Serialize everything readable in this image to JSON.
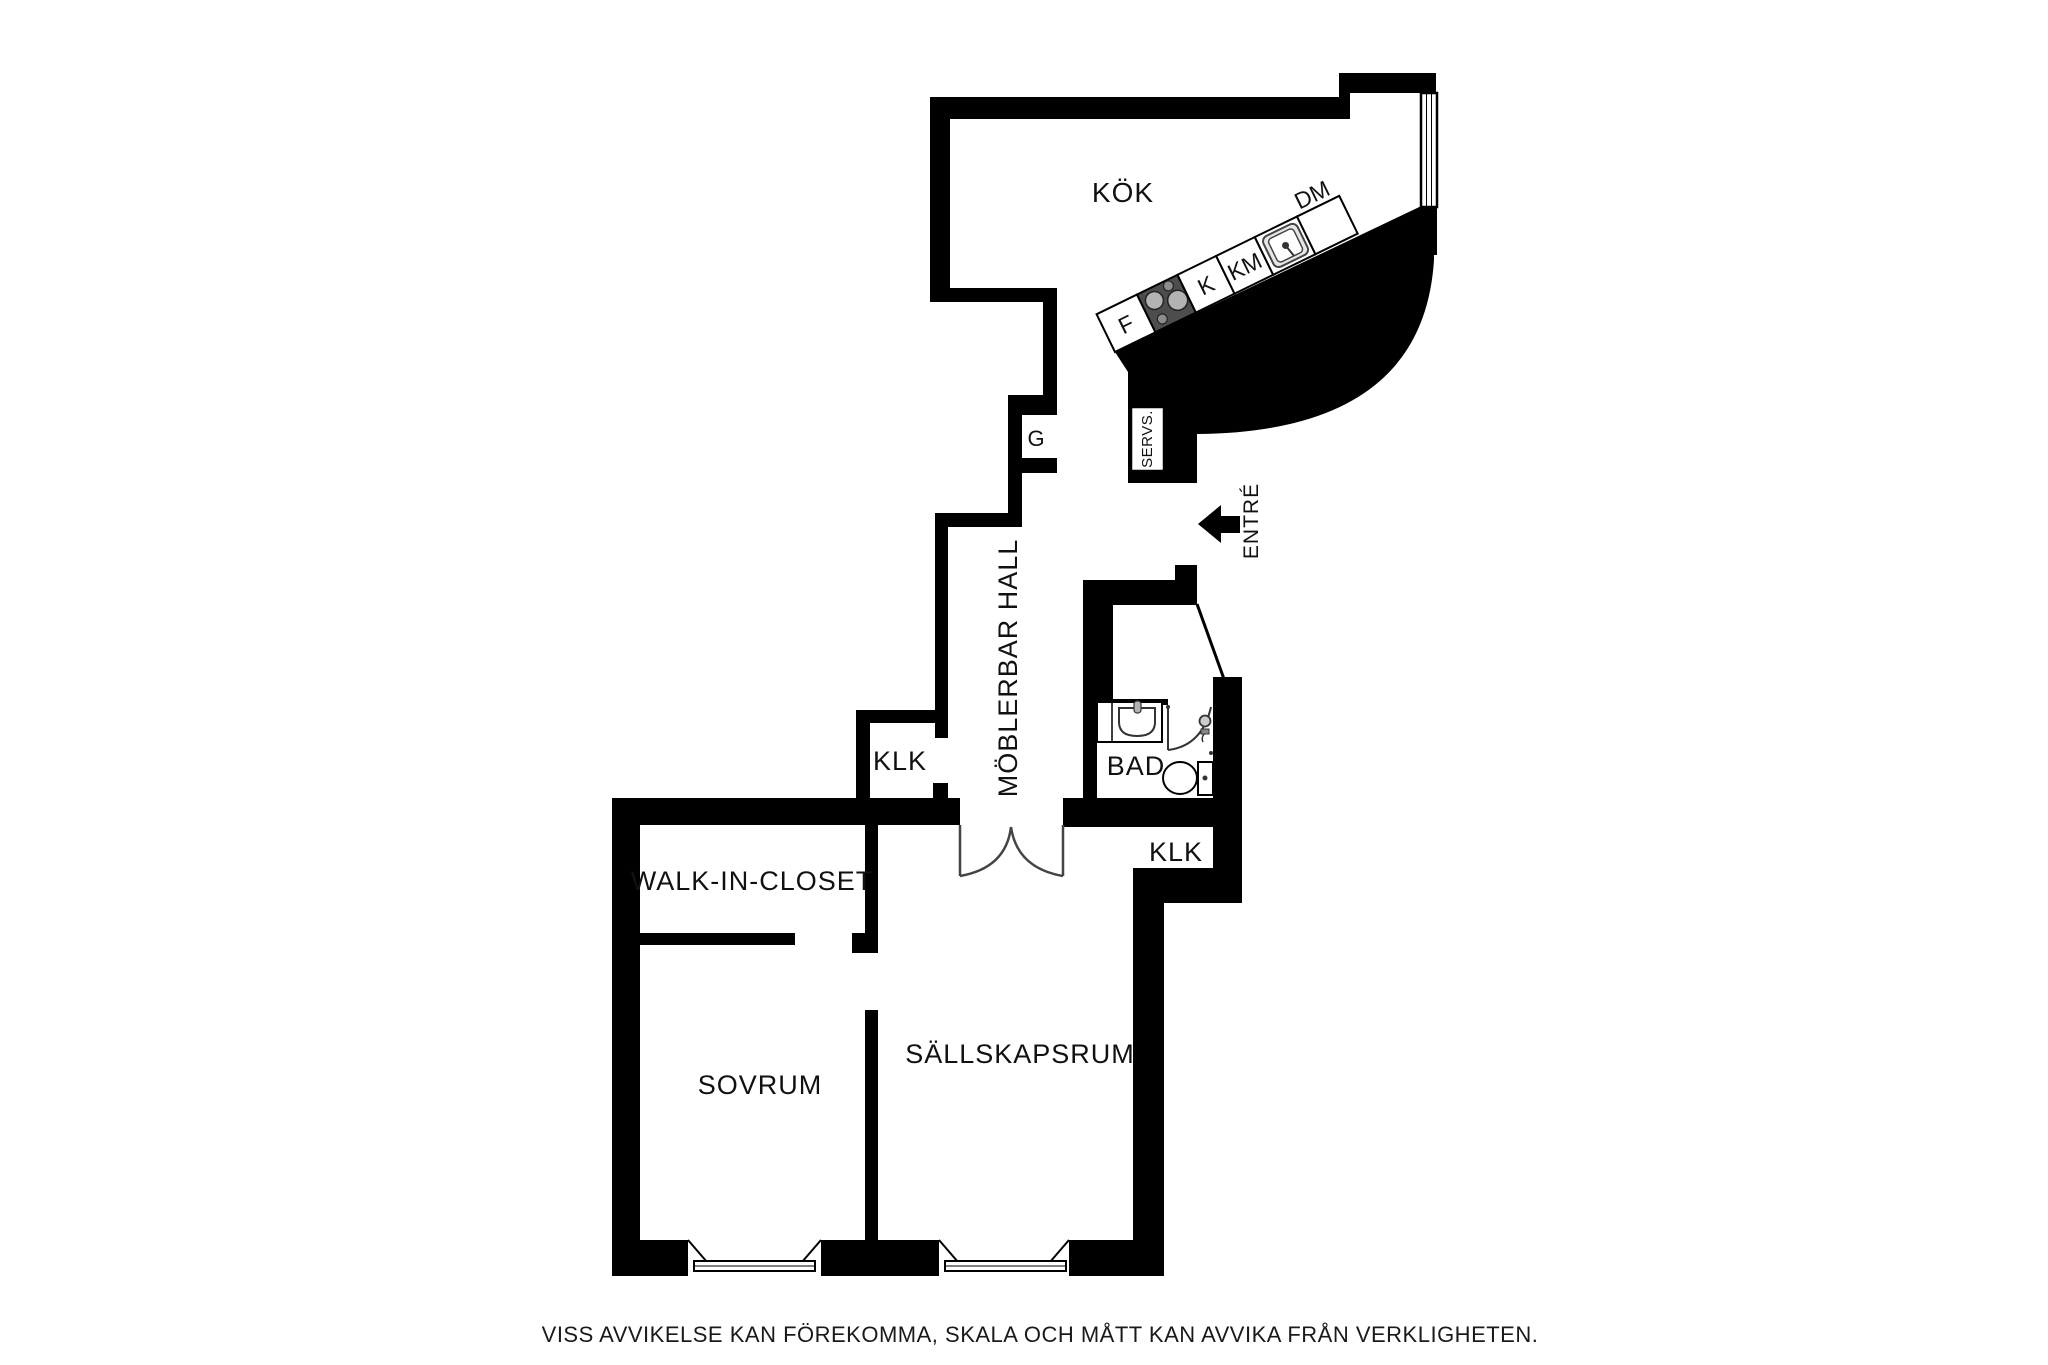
{
  "page": {
    "disclaimer": "VISS AVVIKELSE KAN FÖREKOMMA, SKALA OCH MÅTT KAN AVVIKA FRÅN VERKLIGHETEN."
  },
  "floorplan": {
    "rooms": {
      "kok": "KÖK",
      "hall": "MÖBLERBAR HALL",
      "klk_upper": "KLK",
      "bad": "BAD",
      "klk_lower": "KLK",
      "walk_in_closet": "WALK-IN-CLOSET",
      "sovrum": "SOVRUM",
      "sallskapsrum": "SÄLLSKAPSRUM",
      "garderob": "G",
      "servs": "SERVS.",
      "entre": "ENTRÉ"
    },
    "appliances": {
      "fridge": "F",
      "kyl": "K",
      "km": "KM",
      "dm": "DM"
    },
    "colors": {
      "wall": "#000000",
      "hob": "#4d4d4d",
      "text": "#111111"
    }
  }
}
